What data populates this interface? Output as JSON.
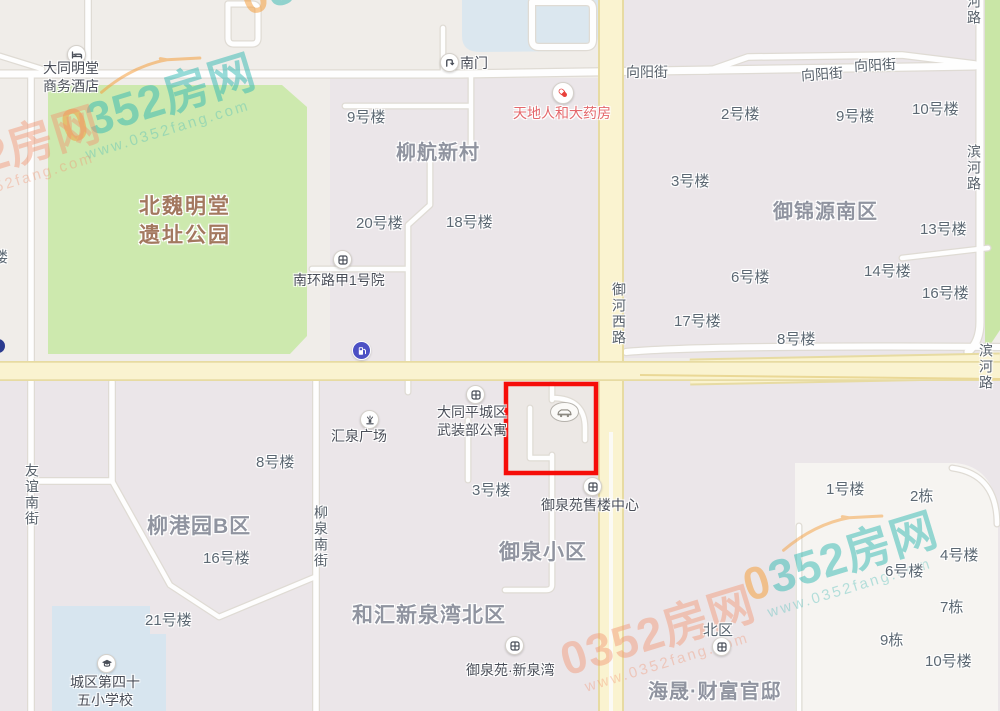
{
  "map": {
    "park": {
      "line1": "北魏明堂",
      "line2": "遗址公园"
    },
    "areas": [
      {
        "id": "liuhang-xincun",
        "label": "柳航新村"
      },
      {
        "id": "yujinyuan-nanqu",
        "label": "御锦源南区"
      },
      {
        "id": "liugangyuan-b",
        "label": "柳港园B区"
      },
      {
        "id": "yuquan-xiaoqu",
        "label": "御泉小区"
      },
      {
        "id": "hehui-xinquanwan-beiqu",
        "label": "和汇新泉湾北区"
      },
      {
        "id": "haisheng-caifu-guandi",
        "label": "海晟·财富官邸"
      }
    ],
    "roads": [
      {
        "label": "向阳街"
      },
      {
        "label": "向阳街"
      },
      {
        "label": "向阳街"
      },
      {
        "label": "滨河路"
      },
      {
        "label": "滨河路"
      },
      {
        "label": "滨河路"
      },
      {
        "label": "御河西路"
      },
      {
        "label": "友谊南街"
      },
      {
        "label": "柳泉南街"
      }
    ],
    "buildings": [
      {
        "label": "9号楼"
      },
      {
        "label": "20号楼"
      },
      {
        "label": "18号楼"
      },
      {
        "label": "2号楼"
      },
      {
        "label": "9号楼"
      },
      {
        "label": "10号楼"
      },
      {
        "label": "3号楼"
      },
      {
        "label": "13号楼"
      },
      {
        "label": "14号楼"
      },
      {
        "label": "16号楼"
      },
      {
        "label": "6号楼"
      },
      {
        "label": "17号楼"
      },
      {
        "label": "8号楼"
      },
      {
        "label": "8号楼"
      },
      {
        "label": "16号楼"
      },
      {
        "label": "21号楼"
      },
      {
        "label": "3号楼"
      },
      {
        "label": "1号楼"
      },
      {
        "label": "2栋"
      },
      {
        "label": "4号楼"
      },
      {
        "label": "6号楼"
      },
      {
        "label": "7栋"
      },
      {
        "label": "9栋"
      },
      {
        "label": "10号楼"
      },
      {
        "label": "北区"
      },
      {
        "label": "楼"
      }
    ],
    "pois": [
      {
        "id": "hotel",
        "line1": "大同明堂",
        "line2": "商务酒店"
      },
      {
        "id": "south-gate",
        "label": "南门"
      },
      {
        "id": "pharmacy",
        "label": "天地人和大药房"
      },
      {
        "id": "nanhuanlu-jia1",
        "label": "南环路甲1号院"
      },
      {
        "id": "huiquan-plaza",
        "label": "汇泉广场"
      },
      {
        "id": "armed-forces-apt",
        "line1": "大同平城区",
        "line2": "武装部公寓"
      },
      {
        "id": "yuquanyuan-sales",
        "label": "御泉苑售楼中心"
      },
      {
        "id": "yuquanyuan-xinquanwan",
        "label": "御泉苑·新泉湾"
      },
      {
        "id": "school",
        "line1": "城区第四十",
        "line2": "五小学校"
      }
    ],
    "colors": {
      "park_green": "#cde9ae",
      "greenbelt": "#c9e6a6",
      "water": "#dbe7ef",
      "major_road": "#faf3d0",
      "highlight_red": "#f60d09",
      "school_blue": "#d7e5ef"
    }
  },
  "watermark": {
    "zero": "0",
    "brand": "352房网",
    "url": "www.0352fang.com"
  }
}
